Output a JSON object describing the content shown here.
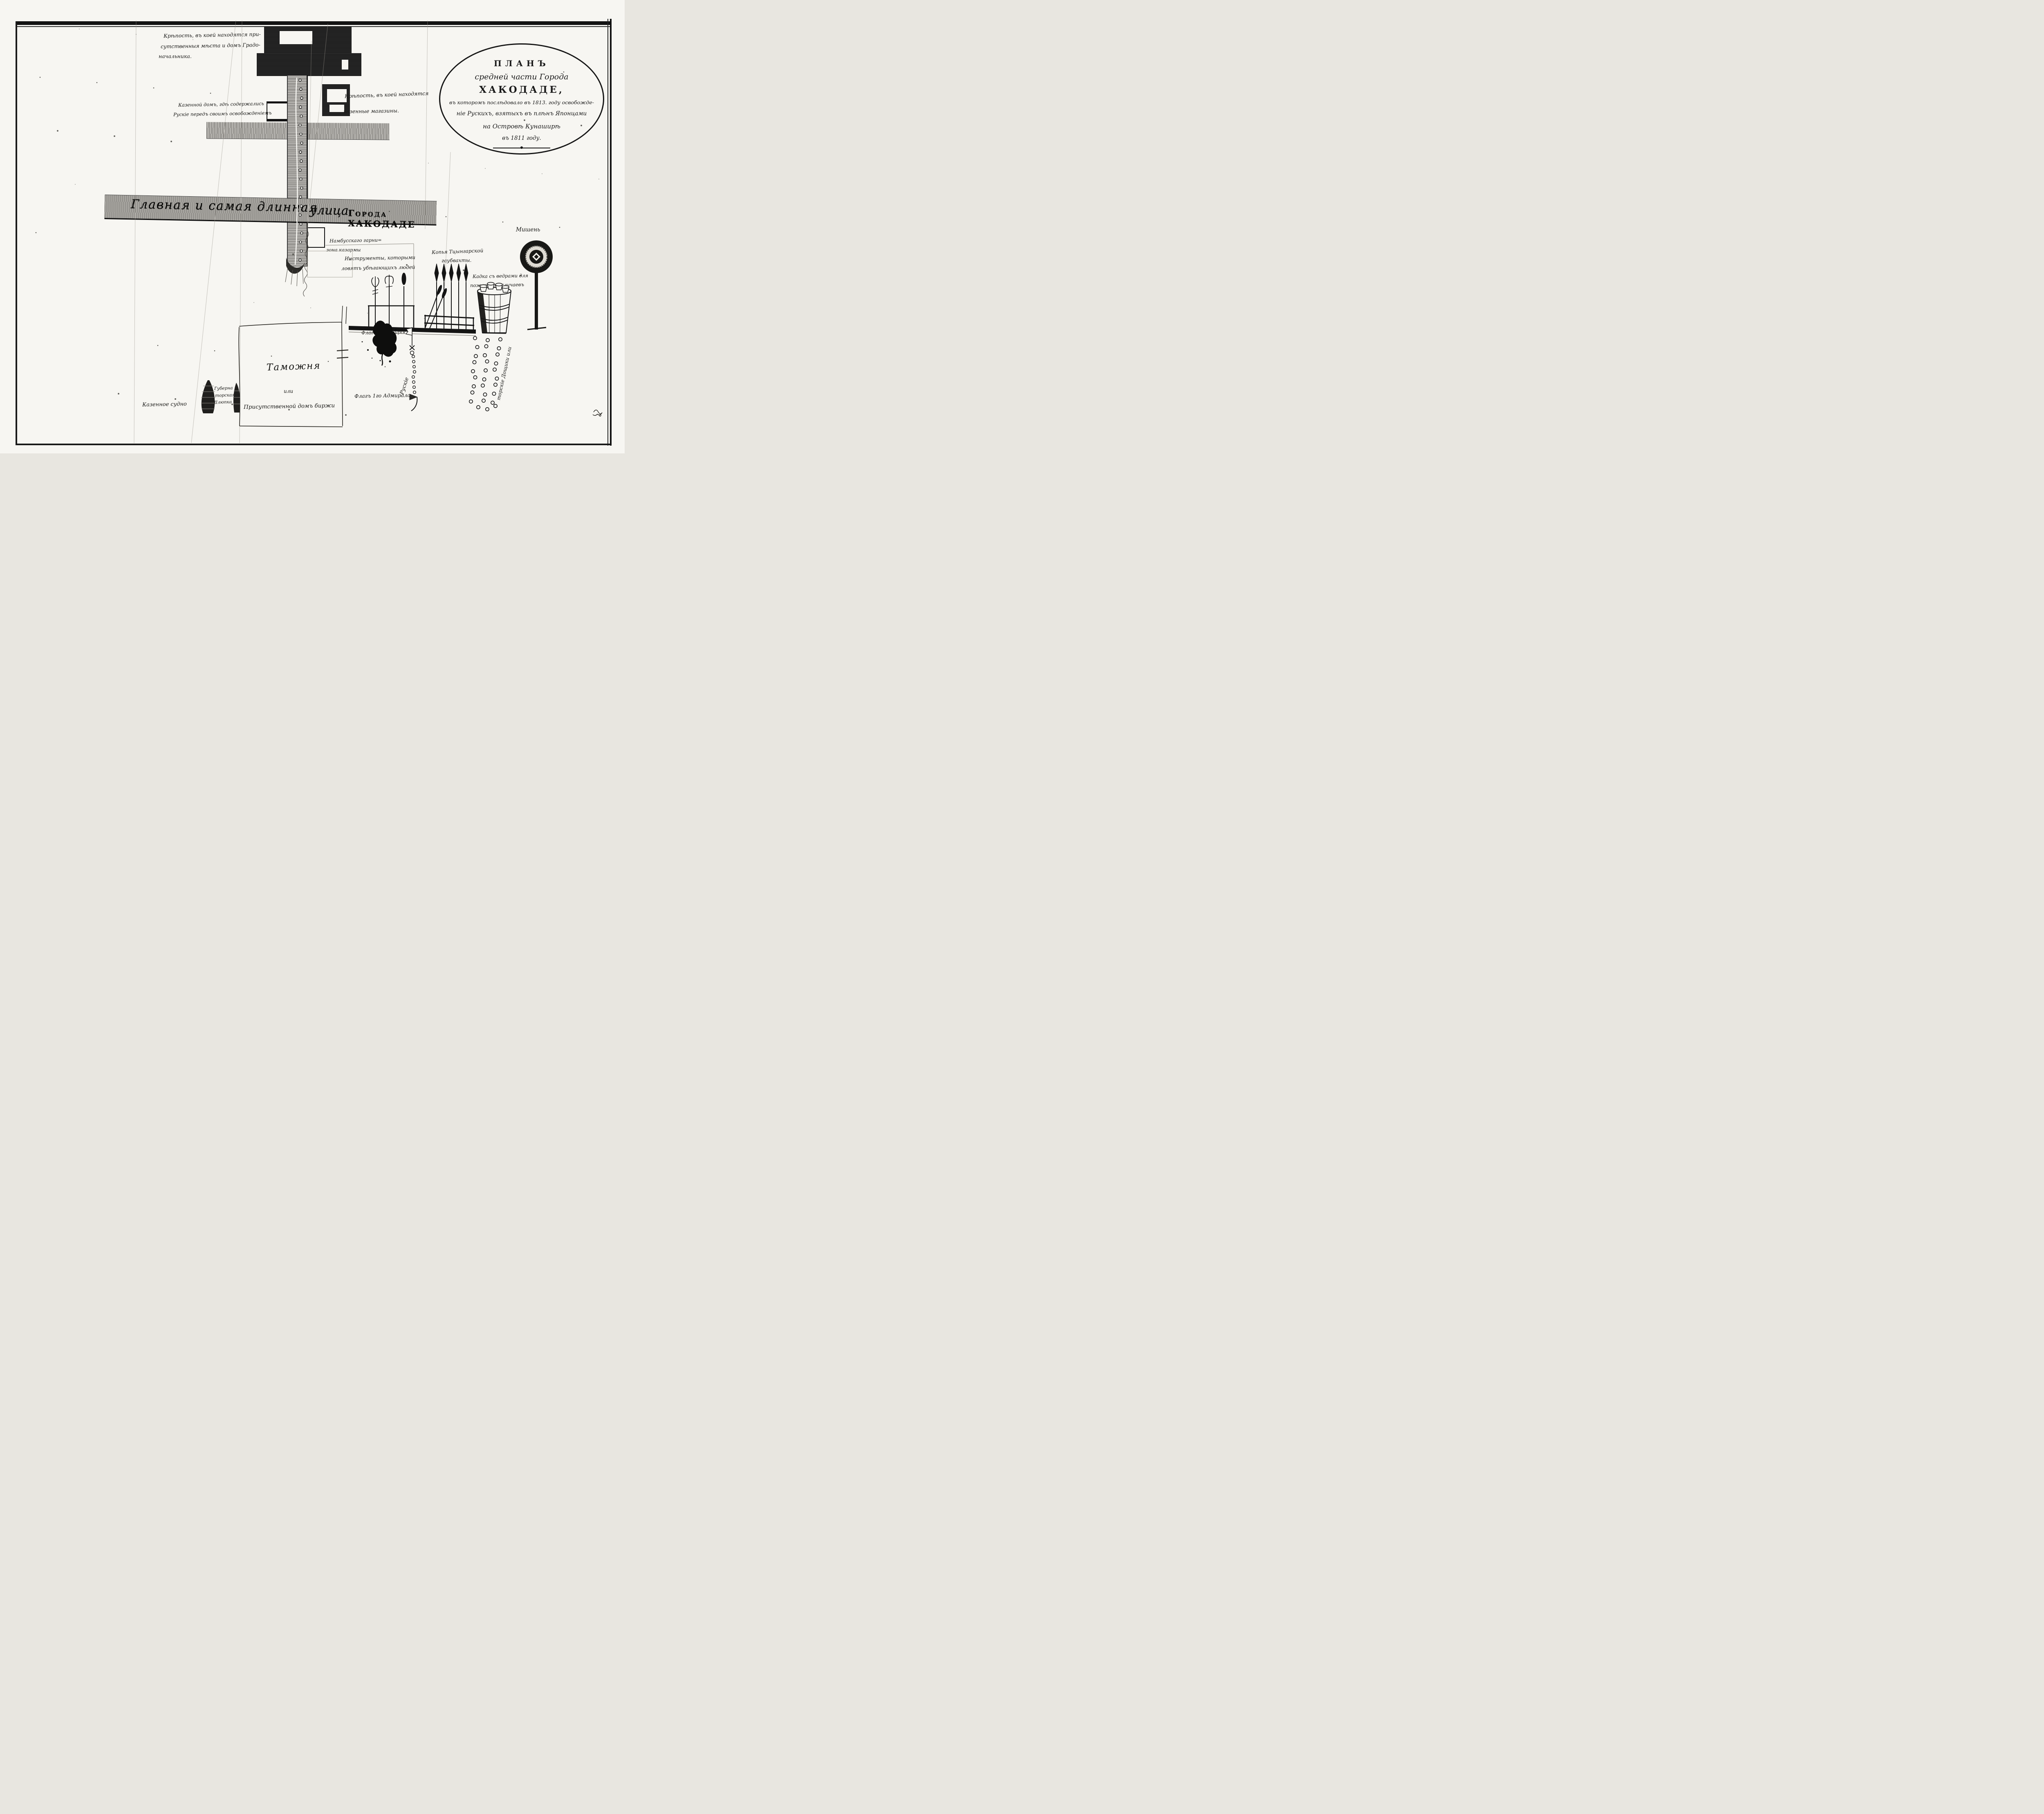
{
  "map_title": {
    "lines": [
      "ПЛАНЪ",
      "средней части Города",
      "ХАКОДАДЕ,",
      "въ которомъ послѣдовало въ 1813. году освобожде-",
      "ніе Рускихъ, взятыхъ въ плѣнъ Японцами",
      "на Островѣ Кунаширѣ",
      "въ 1811 году."
    ]
  },
  "annotations": {
    "fortress_note": [
      "Крѣпость, въ коей находятся при-",
      "сутственныя мѣста и домъ Градо-",
      "начальника."
    ],
    "state_house_note": [
      "Казенной домъ, гдѣ содержались",
      "Рускіе передъ своимъ освобожденіемъ"
    ],
    "magazine_fortress_note": [
      "Крѣпость, въ коей находятся",
      "казенные магазины."
    ],
    "main_street": [
      "Главная и самая длинная",
      "улица",
      "Города ХАКОДАДЕ"
    ],
    "garrison_barracks": [
      "Намбусскаго гарни=",
      "зона казармы"
    ],
    "instruments_note": [
      "Инструменты, которыми",
      "ловятъ убѣгающихъ людей"
    ],
    "spears_note": [
      "Копья Тцынгарской",
      "гаубвахты."
    ],
    "target": "Мишень",
    "fire_tub_note": [
      "Кадка съ ведрами для",
      "пожарныхъ случаевъ"
    ],
    "truce_flag": "Флагъ Перемирія",
    "admiral_flag": "Флагъ 1го Адмирала",
    "russians": "Рускіе",
    "bucket_trail_note": "торскіе Дощики или",
    "customs_house": [
      "Таможня",
      "или",
      "Присутственной домъ биржи"
    ],
    "state_vessel": "Казенное судно",
    "governor_boat": [
      "Губерна",
      "торская",
      "Шлюпка"
    ]
  }
}
